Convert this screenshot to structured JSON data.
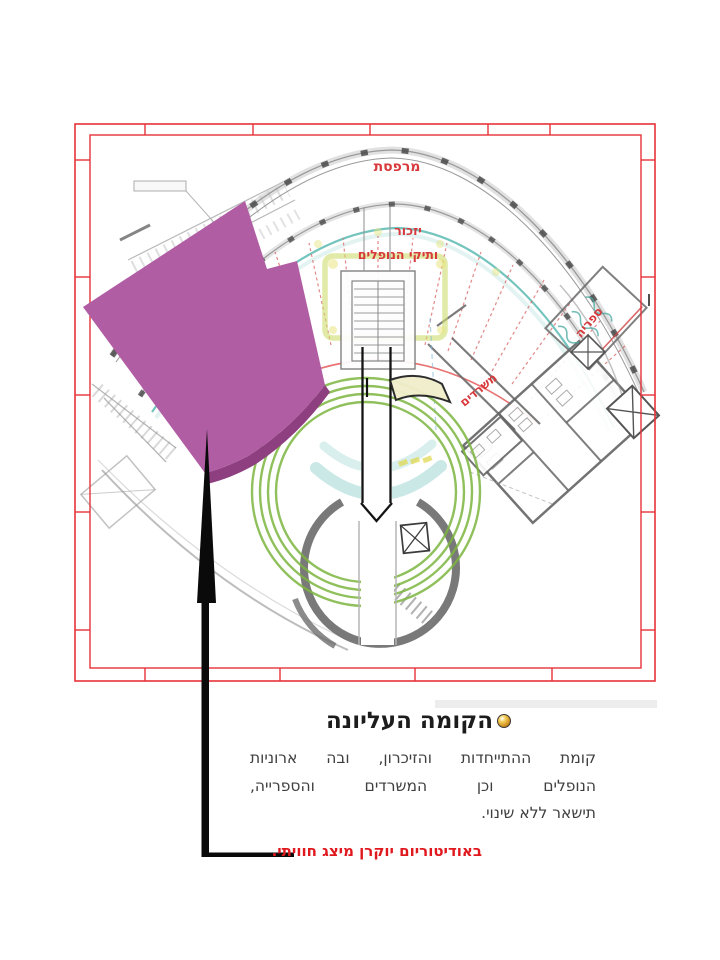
{
  "plan": {
    "labels": {
      "terrace": "מרפסת",
      "yizkor_line1": "יזכור",
      "yizkor_line2": "ותיקי הנופלים",
      "library": "ספריה",
      "offices": "משרדים"
    },
    "colors": {
      "frame_red": "#e63238",
      "label_red": "#d8393c",
      "overlay_magenta": "#b15da4",
      "overlay_edge": "#8e3f80",
      "ring_green": "#7cb63f",
      "teal": "#4db4ac"
    }
  },
  "caption": {
    "title": "הקומה העליונה",
    "body_lines": {
      "line1": "קומת ההתייחדות והזיכרון, ובה ארוניות",
      "line2": "הנופלים וכן המשרדים והספרייה,",
      "line3": "תישאר ללא שינוי."
    },
    "highlight": "באודיטוריום יוקרן מיצג חוויתי.",
    "highlight_color": "#e0191f"
  }
}
